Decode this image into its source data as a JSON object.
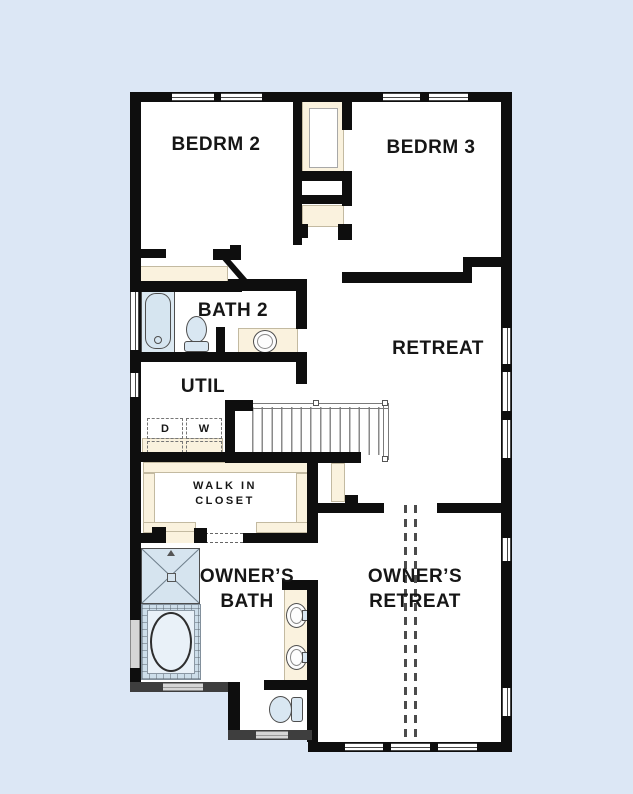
{
  "colors": {
    "background": "#dce7f5",
    "wall": "#0e0e0e",
    "gray_wall": "#3e3e3e",
    "casework": "#faf2de",
    "fixture_fill": "#d9e7f2"
  },
  "rooms": {
    "bedroom2": {
      "label": "BEDRM 2"
    },
    "bedroom3": {
      "label": "BEDRM 3"
    },
    "bath2": {
      "label": "BATH 2"
    },
    "retreat": {
      "label": "RETREAT"
    },
    "util": {
      "label": "UTIL"
    },
    "walk_in_closet": {
      "line1": "WALK IN",
      "line2": "CLOSET"
    },
    "owners_bath": {
      "line1": "OWNER’S",
      "line2": "BATH"
    },
    "owners_retreat": {
      "line1": "OWNER’S",
      "line2": "RETREAT"
    }
  },
  "appliances": {
    "dryer": "D",
    "washer": "W"
  }
}
